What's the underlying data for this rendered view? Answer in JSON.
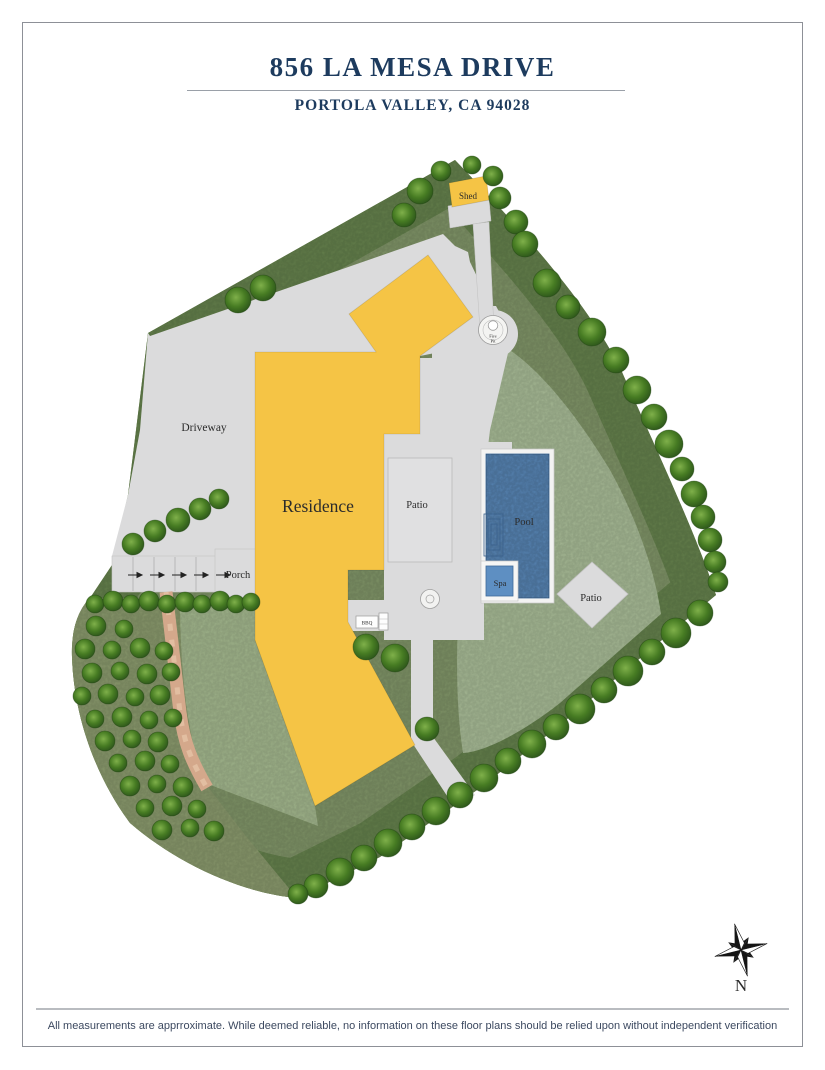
{
  "header": {
    "title": "856 LA MESA DRIVE",
    "subtitle": "PORTOLA VALLEY, CA 94028"
  },
  "footer": {
    "disclaimer": "All measurements are apprroximate. While deemed reliable, no information on these floor plans should be relied upon without independent verification"
  },
  "site_plan": {
    "labels": {
      "driveway": "Driveway",
      "residence": "Residence",
      "patio_center": "Patio",
      "pool": "Pool",
      "spa": "Spa",
      "patio_southeast": "Patio",
      "porch": "Porch",
      "shed": "Shed",
      "fire_pit_line1": "Fire",
      "fire_pit_line2": "Pit",
      "bbq": "BBQ"
    },
    "compass": {
      "north_label": "N"
    }
  },
  "colors": {
    "title_navy": "#1d3b5e",
    "residence_yellow": "#f5c445",
    "pool_blue": "#5e8fc2",
    "lawn_green": "#adc19b",
    "lawn_green_lower": "#a8bd92",
    "base_green": "#84996b",
    "band_green": "#68854f",
    "orchard_green": "#8e9e70",
    "hardscape_gray": "#dbdbdc",
    "path_tan": "#d4a88b",
    "tree_green": "#477c23",
    "compass_black": "#141414"
  }
}
